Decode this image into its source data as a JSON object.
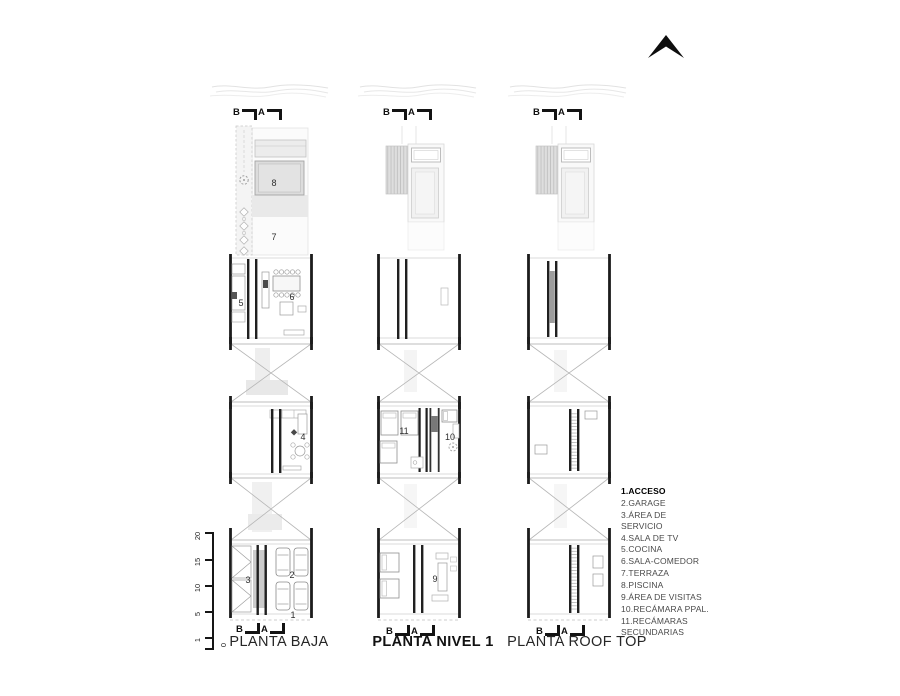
{
  "sheet": {
    "compass_icon": "north-arrow"
  },
  "plans": [
    {
      "title": "PLANTA BAJA",
      "section_markers": {
        "b": "B",
        "a": "A"
      },
      "room_labels": {
        "1": "1",
        "2": "2",
        "3": "3",
        "4": "4",
        "5": "5",
        "6": "6",
        "7": "7",
        "8": "8"
      }
    },
    {
      "title": "PLANTA NIVEL 1",
      "section_markers": {
        "b": "B",
        "a": "A"
      },
      "room_labels": {
        "9": "9",
        "10": "10",
        "11": "11"
      }
    },
    {
      "title": "PLANTA ROOF TOP",
      "section_markers": {
        "b": "B",
        "a": "A"
      },
      "room_labels": {}
    }
  ],
  "legend": {
    "items": [
      {
        "label": "1.ACCESO",
        "bold": true
      },
      {
        "label": "2.GARAGE"
      },
      {
        "label": "3.ÁREA DE\nSERVICIO"
      },
      {
        "label": "4.SALA DE TV"
      },
      {
        "label": "5.COCINA"
      },
      {
        "label": "6.SALA-COMEDOR"
      },
      {
        "label": "7.TERRAZA"
      },
      {
        "label": "8.PISCINA"
      },
      {
        "label": "9.ÁREA DE VISITAS"
      },
      {
        "label": "10.RECÁMARA PPAL."
      },
      {
        "label": "11.RECÁMARAS\nSECUNDARIAS"
      }
    ]
  },
  "scale_bar": {
    "labels": [
      "20",
      "15",
      "10",
      "5",
      "1",
      "0"
    ]
  },
  "colors": {
    "wall": "#1c1c1c",
    "light_fill": "#e6e6e6",
    "hatch": "#d9d9d9",
    "muted_line": "#9a9a9a"
  }
}
